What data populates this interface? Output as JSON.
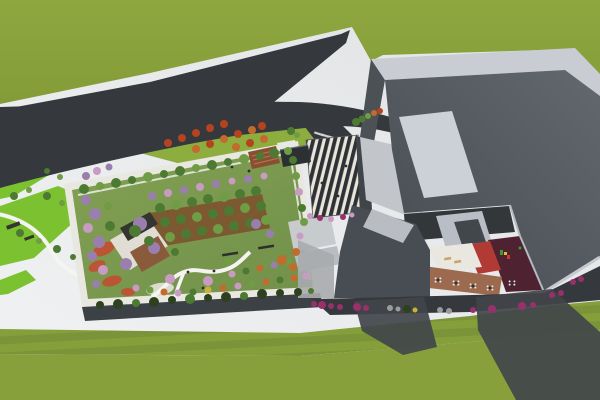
{
  "palette": {
    "pavement_a": "#f1f2f3",
    "pavement_b": "#e0e2e4",
    "grass_field": "#8ba23c",
    "grass_plain": "#87a03b",
    "grass_striped_a": "#85a03a",
    "grass_striped_b": "#7b943a",
    "lawn_bright": "#7cc230",
    "lawn_upper": "#8dad3e",
    "garden_lawn_a": "#83a153",
    "garden_lawn_b": "#71904a",
    "parapet_white": "#e9e8e0",
    "facade_dark": "#3c4145",
    "road": "#35383c",
    "band_light": "#c9cdd3",
    "roof_dark_a": "#62686d",
    "roof_dark_b": "#454b50",
    "wall_dark": "#4b5155",
    "wall_lit": "#c2c6ca",
    "wall_return": "#3f4549",
    "panel_light": "#ccd1d8",
    "canopy_dark": "#2e3135",
    "canopy_light": "#e9e5da",
    "stairs_a": "#c7cbce",
    "stairs_b": "#b9bdc1",
    "courtyard_back": "#33373a",
    "courtyard_facet": "#b9bec6",
    "skylight_dark": "#42474c",
    "courtyard_white": "#eae7e1",
    "courtyard_red": "#b23a34",
    "courtyard_maroon": "#4e2230",
    "courtyard_brown": "#9c6a4e",
    "tan_chair": "#c8a56a",
    "table_white": "#e8e8e8",
    "table_dark": "#333333",
    "wing_dark": "#474d52",
    "wing_top": "#b9bdc2",
    "eave_light": "#b5bac0",
    "fascia_light": "#c6cad0",
    "shadow_dark": "#41454a",
    "shadow_soft": "#a8abae",
    "deck_white": "#e0ddd5",
    "pergola_dark": "#343431",
    "deck_brown": "#8a5a3c",
    "orchard_soil": "#7c4e2c",
    "amphi_brown": "#8a4f33",
    "amphi_step": "#b07a4f",
    "kiosk_dark": "#2d3033",
    "flower_red": "#c24e31",
    "path_white": "#f4f4f1",
    "plaza_blob": "#e3e3da",
    "bench_dark": "#2f2f2d",
    "tree_green": "#4d7a32",
    "tree_green_light": "#6f9c44",
    "tree_purple": "#9a7fae",
    "tree_pink": "#c89bc3",
    "tree_orange": "#c36a2d",
    "tree_red": "#b5431f",
    "tree_yellow": "#c9b23a",
    "hedge_dark": "#2e401f",
    "shrub_magenta": "#98306c",
    "shrub_gray": "#9b9b9b",
    "play_green": "#3a9d3a",
    "play_yellow": "#d8c22e",
    "play_red": "#c23a34",
    "person_dark": "#2d2d2d"
  },
  "vegetation": {
    "garden_top_row": [
      [
        84,
        189,
        5,
        "tree_green"
      ],
      [
        100,
        186,
        4,
        "tree_green_light"
      ],
      [
        116,
        183,
        5,
        "tree_green"
      ],
      [
        132,
        180,
        4,
        "tree_green"
      ],
      [
        148,
        177,
        5,
        "tree_green_light"
      ],
      [
        164,
        174,
        4,
        "tree_green"
      ],
      [
        180,
        171,
        5,
        "tree_green"
      ],
      [
        196,
        168,
        4,
        "tree_green_light"
      ],
      [
        212,
        165,
        5,
        "tree_green"
      ],
      [
        228,
        162,
        4,
        "tree_green"
      ],
      [
        244,
        159,
        5,
        "tree_green_light"
      ],
      [
        260,
        156,
        4,
        "tree_green"
      ],
      [
        274,
        153,
        5,
        "tree_green"
      ],
      [
        288,
        151,
        4,
        "tree_green_light"
      ]
    ],
    "garden_purple_row": [
      [
        152,
        196,
        4,
        "tree_purple"
      ],
      [
        168,
        193,
        4,
        "tree_pink"
      ],
      [
        184,
        190,
        4,
        "tree_purple"
      ],
      [
        200,
        187,
        4,
        "tree_pink"
      ],
      [
        216,
        184,
        4,
        "tree_purple"
      ],
      [
        232,
        181,
        3.5,
        "tree_pink"
      ],
      [
        248,
        179,
        4,
        "tree_purple"
      ],
      [
        264,
        176,
        3.5,
        "tree_pink"
      ]
    ],
    "garden_left_cluster": [
      [
        86,
        200,
        5,
        "tree_purple"
      ],
      [
        95,
        214,
        6,
        "tree_purple"
      ],
      [
        88,
        228,
        5,
        "tree_pink"
      ],
      [
        99,
        242,
        6,
        "tree_purple"
      ],
      [
        92,
        256,
        5,
        "tree_purple"
      ],
      [
        103,
        270,
        5,
        "tree_pink"
      ],
      [
        96,
        284,
        4,
        "tree_purple"
      ],
      [
        110,
        226,
        5,
        "tree_green"
      ],
      [
        108,
        206,
        4,
        "tree_green_light"
      ]
    ],
    "orchard_grid": [
      [
        160,
        208,
        5,
        "tree_green"
      ],
      [
        176,
        205,
        5,
        "tree_green_light"
      ],
      [
        192,
        202,
        5,
        "tree_green"
      ],
      [
        208,
        199,
        5,
        "tree_green"
      ],
      [
        224,
        197,
        5,
        "tree_green_light"
      ],
      [
        240,
        194,
        5,
        "tree_green"
      ],
      [
        256,
        191,
        5,
        "tree_green"
      ],
      [
        165,
        222,
        5,
        "tree_green"
      ],
      [
        181,
        219,
        5,
        "tree_green"
      ],
      [
        197,
        217,
        5,
        "tree_green_light"
      ],
      [
        213,
        214,
        5,
        "tree_green"
      ],
      [
        229,
        211,
        5,
        "tree_green"
      ],
      [
        245,
        208,
        5,
        "tree_green_light"
      ],
      [
        261,
        206,
        5,
        "tree_green"
      ],
      [
        170,
        237,
        5,
        "tree_green_light"
      ],
      [
        186,
        234,
        5,
        "tree_green"
      ],
      [
        202,
        231,
        5,
        "tree_green"
      ],
      [
        218,
        229,
        5,
        "tree_green_light"
      ],
      [
        234,
        226,
        5,
        "tree_green"
      ],
      [
        250,
        223,
        5,
        "tree_green"
      ],
      [
        266,
        220,
        5,
        "tree_green_light"
      ]
    ],
    "garden_right_row": [
      [
        293,
        160,
        4,
        "tree_green"
      ],
      [
        296,
        176,
        4,
        "tree_green_light"
      ],
      [
        299,
        192,
        4,
        "tree_pink"
      ],
      [
        302,
        208,
        4,
        "tree_green"
      ],
      [
        304,
        222,
        4,
        "tree_green_light"
      ],
      [
        300,
        236,
        3.5,
        "tree_pink"
      ]
    ],
    "garden_bottom_shrubs": [
      [
        136,
        288,
        3.5,
        "tree_pink"
      ],
      [
        150,
        290,
        3.5,
        "tree_green_light"
      ],
      [
        164,
        292,
        3.5,
        "tree_orange"
      ],
      [
        178,
        293,
        3.5,
        "tree_pink"
      ],
      [
        193,
        292,
        3.5,
        "tree_green"
      ],
      [
        208,
        290,
        3.5,
        "tree_yellow"
      ],
      [
        223,
        288,
        3.5,
        "tree_orange"
      ],
      [
        238,
        286,
        3.5,
        "tree_pink"
      ],
      [
        252,
        284,
        3.5,
        "tree_green_light"
      ],
      [
        266,
        282,
        3.5,
        "tree_orange"
      ],
      [
        280,
        280,
        3.5,
        "tree_green"
      ],
      [
        294,
        278,
        3.5,
        "tree_orange"
      ],
      [
        306,
        276,
        3.5,
        "tree_pink"
      ],
      [
        232,
        274,
        3.5,
        "tree_pink"
      ],
      [
        246,
        271,
        3.5,
        "tree_green"
      ],
      [
        260,
        268,
        3.5,
        "tree_orange"
      ],
      [
        274,
        265,
        3.5,
        "tree_purple"
      ],
      [
        288,
        262,
        3.5,
        "tree_green_light"
      ],
      [
        296,
        252,
        4,
        "tree_orange"
      ]
    ],
    "garden_scatter": [
      [
        140,
        224,
        7,
        "tree_purple"
      ],
      [
        154,
        248,
        6,
        "tree_purple"
      ],
      [
        126,
        264,
        6,
        "tree_purple"
      ],
      [
        170,
        279,
        5,
        "tree_pink"
      ],
      [
        208,
        281,
        5,
        "tree_pink"
      ],
      [
        256,
        224,
        5,
        "tree_purple"
      ],
      [
        270,
        234,
        4,
        "tree_purple"
      ],
      [
        282,
        260,
        5,
        "tree_orange"
      ],
      [
        293,
        267,
        4,
        "tree_orange"
      ],
      [
        135,
        231,
        6,
        "tree_green"
      ],
      [
        149,
        241,
        5,
        "tree_green"
      ],
      [
        228,
        262,
        4,
        "tree_green_light"
      ],
      [
        175,
        252,
        4,
        "tree_green"
      ]
    ],
    "upper_lawn_trees": [
      [
        168,
        143,
        4,
        "tree_red"
      ],
      [
        182,
        138,
        4,
        "tree_red"
      ],
      [
        196,
        133,
        4,
        "tree_red"
      ],
      [
        210,
        128,
        4,
        "tree_red"
      ],
      [
        224,
        124,
        4,
        "tree_red"
      ],
      [
        196,
        149,
        4,
        "tree_orange"
      ],
      [
        210,
        144,
        4,
        "tree_red"
      ],
      [
        224,
        139,
        4,
        "tree_orange"
      ],
      [
        238,
        134,
        4,
        "tree_red"
      ],
      [
        252,
        130,
        4,
        "tree_orange"
      ],
      [
        262,
        126,
        4,
        "tree_red"
      ],
      [
        236,
        147,
        4,
        "tree_orange"
      ],
      [
        250,
        143,
        4,
        "tree_red"
      ],
      [
        264,
        139,
        4,
        "tree_orange"
      ]
    ],
    "plaza_trees": [
      [
        291,
        131,
        4,
        "tree_green"
      ],
      [
        297,
        135,
        3,
        "tree_green_light"
      ],
      [
        356,
        122,
        4,
        "tree_green"
      ],
      [
        362,
        119,
        3.5,
        "tree_green"
      ],
      [
        368,
        116,
        3,
        "tree_green_light"
      ],
      [
        374,
        113,
        3,
        "tree_orange"
      ],
      [
        380,
        111,
        3,
        "tree_red"
      ]
    ],
    "left_lawn_bushes": [
      [
        14,
        196,
        4,
        "tree_green"
      ],
      [
        29,
        190,
        3,
        "tree_green_light"
      ],
      [
        47,
        196,
        4,
        "tree_green"
      ],
      [
        62,
        203,
        3,
        "tree_green_light"
      ],
      [
        20,
        233,
        4,
        "tree_green"
      ],
      [
        39,
        241,
        3,
        "tree_green_light"
      ],
      [
        57,
        249,
        4,
        "tree_green"
      ],
      [
        73,
        257,
        3,
        "tree_green"
      ],
      [
        86,
        176,
        4,
        "tree_purple"
      ],
      [
        97,
        171,
        4,
        "tree_pink"
      ],
      [
        109,
        167,
        3.5,
        "tree_purple"
      ],
      [
        47,
        171,
        3,
        "tree_green"
      ],
      [
        60,
        177,
        3,
        "tree_green_light"
      ]
    ],
    "front_hedge": [
      [
        100,
        305,
        4,
        "hedge_dark"
      ],
      [
        118,
        304,
        5,
        "hedge_dark"
      ],
      [
        136,
        303,
        4,
        "tree_green"
      ],
      [
        154,
        302,
        5,
        "hedge_dark"
      ],
      [
        172,
        300,
        4,
        "hedge_dark"
      ],
      [
        190,
        299,
        5,
        "tree_green"
      ],
      [
        208,
        298,
        4,
        "hedge_dark"
      ],
      [
        226,
        297,
        5,
        "hedge_dark"
      ],
      [
        244,
        296,
        4,
        "tree_green"
      ],
      [
        262,
        294,
        5,
        "hedge_dark"
      ],
      [
        280,
        293,
        4,
        "hedge_dark"
      ],
      [
        298,
        292,
        4,
        "hedge_dark"
      ],
      [
        311,
        291,
        3,
        "tree_green"
      ]
    ],
    "canopy_shrubs": [
      [
        310,
        216,
        3,
        "tree_pink"
      ],
      [
        320,
        218,
        3,
        "shrub_magenta"
      ],
      [
        331,
        219,
        3,
        "tree_pink"
      ],
      [
        343,
        217,
        3,
        "shrub_magenta"
      ],
      [
        352,
        215,
        2.5,
        "tree_pink"
      ]
    ],
    "roadside_shrubs": [
      [
        314,
        304,
        3,
        "shrub_magenta"
      ],
      [
        322,
        305,
        4,
        "shrub_magenta"
      ],
      [
        331,
        306,
        3,
        "shrub_magenta"
      ],
      [
        340,
        307,
        3,
        "shrub_magenta"
      ],
      [
        357,
        307,
        4,
        "shrub_magenta"
      ],
      [
        366,
        308,
        3,
        "shrub_magenta"
      ],
      [
        390,
        308,
        3,
        "shrub_gray"
      ],
      [
        398,
        309,
        2.5,
        "shrub_gray"
      ],
      [
        407,
        309,
        4,
        "hedge_dark"
      ],
      [
        415,
        310,
        2.5,
        "tree_yellow"
      ],
      [
        440,
        310,
        3,
        "shrub_gray"
      ],
      [
        449,
        311,
        3,
        "shrub_gray"
      ],
      [
        473,
        310,
        3,
        "shrub_magenta"
      ],
      [
        492,
        309,
        4,
        "shrub_magenta"
      ],
      [
        522,
        306,
        4,
        "shrub_magenta"
      ],
      [
        533,
        305,
        3,
        "shrub_magenta"
      ],
      [
        552,
        295,
        3,
        "shrub_magenta"
      ],
      [
        561,
        293,
        3,
        "shrub_magenta"
      ],
      [
        573,
        282,
        3,
        "shrub_magenta"
      ],
      [
        581,
        279,
        3,
        "shrub_magenta"
      ]
    ]
  },
  "people": [
    [
      232,
      167
    ],
    [
      249,
      171
    ],
    [
      322,
      183
    ],
    [
      338,
      196
    ],
    [
      203,
      288
    ],
    [
      214,
      271
    ],
    [
      188,
      272
    ],
    [
      346,
      166
    ]
  ]
}
